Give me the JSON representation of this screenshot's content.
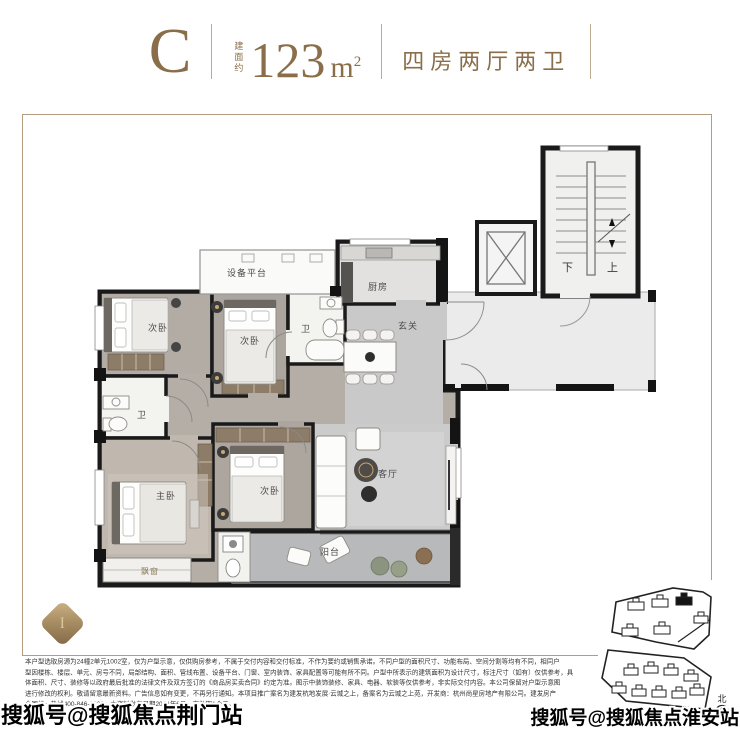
{
  "header": {
    "type_letter": "C",
    "area_prefix": "建面约",
    "area_value": "123",
    "area_unit": "m",
    "area_unit_sup": "2",
    "layout_desc": "四房两厅两卫"
  },
  "plan": {
    "rooms": {
      "equipment_platform": "设备平台",
      "kitchen": "厨房",
      "entry": "玄关",
      "bedroom_a": "次卧",
      "bedroom_b": "次卧",
      "bedroom_c": "次卧",
      "bath_a": "卫",
      "bath_b": "卫",
      "master": "主卧",
      "living": "客厅",
      "balcony": "阳台",
      "bay_window": "飘窗"
    },
    "stair_down": "下",
    "stair_up": "上"
  },
  "site_map": {
    "north_label": "北"
  },
  "badge_letter": "I",
  "watermarks": {
    "bottom_left": "搜狐号@搜狐焦点荆门站",
    "bottom_right": "搜狐号@搜狐焦点淮安站"
  },
  "disclaimer": {
    "lines": [
      "本户型选取房源为24幢2单元1002室，仅为户型示意，仅供购房参考，不属于交付内容和交付标准，不作为要约或销售承诺。不同户型的面积尺寸、功能布局、空间分割等均有不同，相同户",
      "型因楼栋、楼层、单元、房号不同，局部结构、面积、管线布置、设备平台、门窗、室内装饰、家具配置等可能有所不同。户型中所表示的建筑面积为设计尺寸，标注尺寸（如有）仅供参考，具",
      "体面积、尺寸、装修等以政府最后批准的法律文件及双方签订的《商品房买卖合同》约定为准。图示中装饰装修、家具、电器、软装等仅供参考，非实际交付内容。本公司保留对户型示意图",
      "进行修改的权利。敬请留意最新资料。广告信息如有变更，不再另行通知。本项目推广案名为建发杭地发展·云城之上，备案名为云城之上苑，开发商：杭州尚星房地产有限公司。建发房产",
      "全国统一热线400-846-3636；本资料发布日期2024年6月，有效期1个月。"
    ]
  },
  "colors": {
    "accent_brown": "#8a6e4a",
    "frame_line": "#b49c80",
    "wall": "#1a1a1a"
  }
}
